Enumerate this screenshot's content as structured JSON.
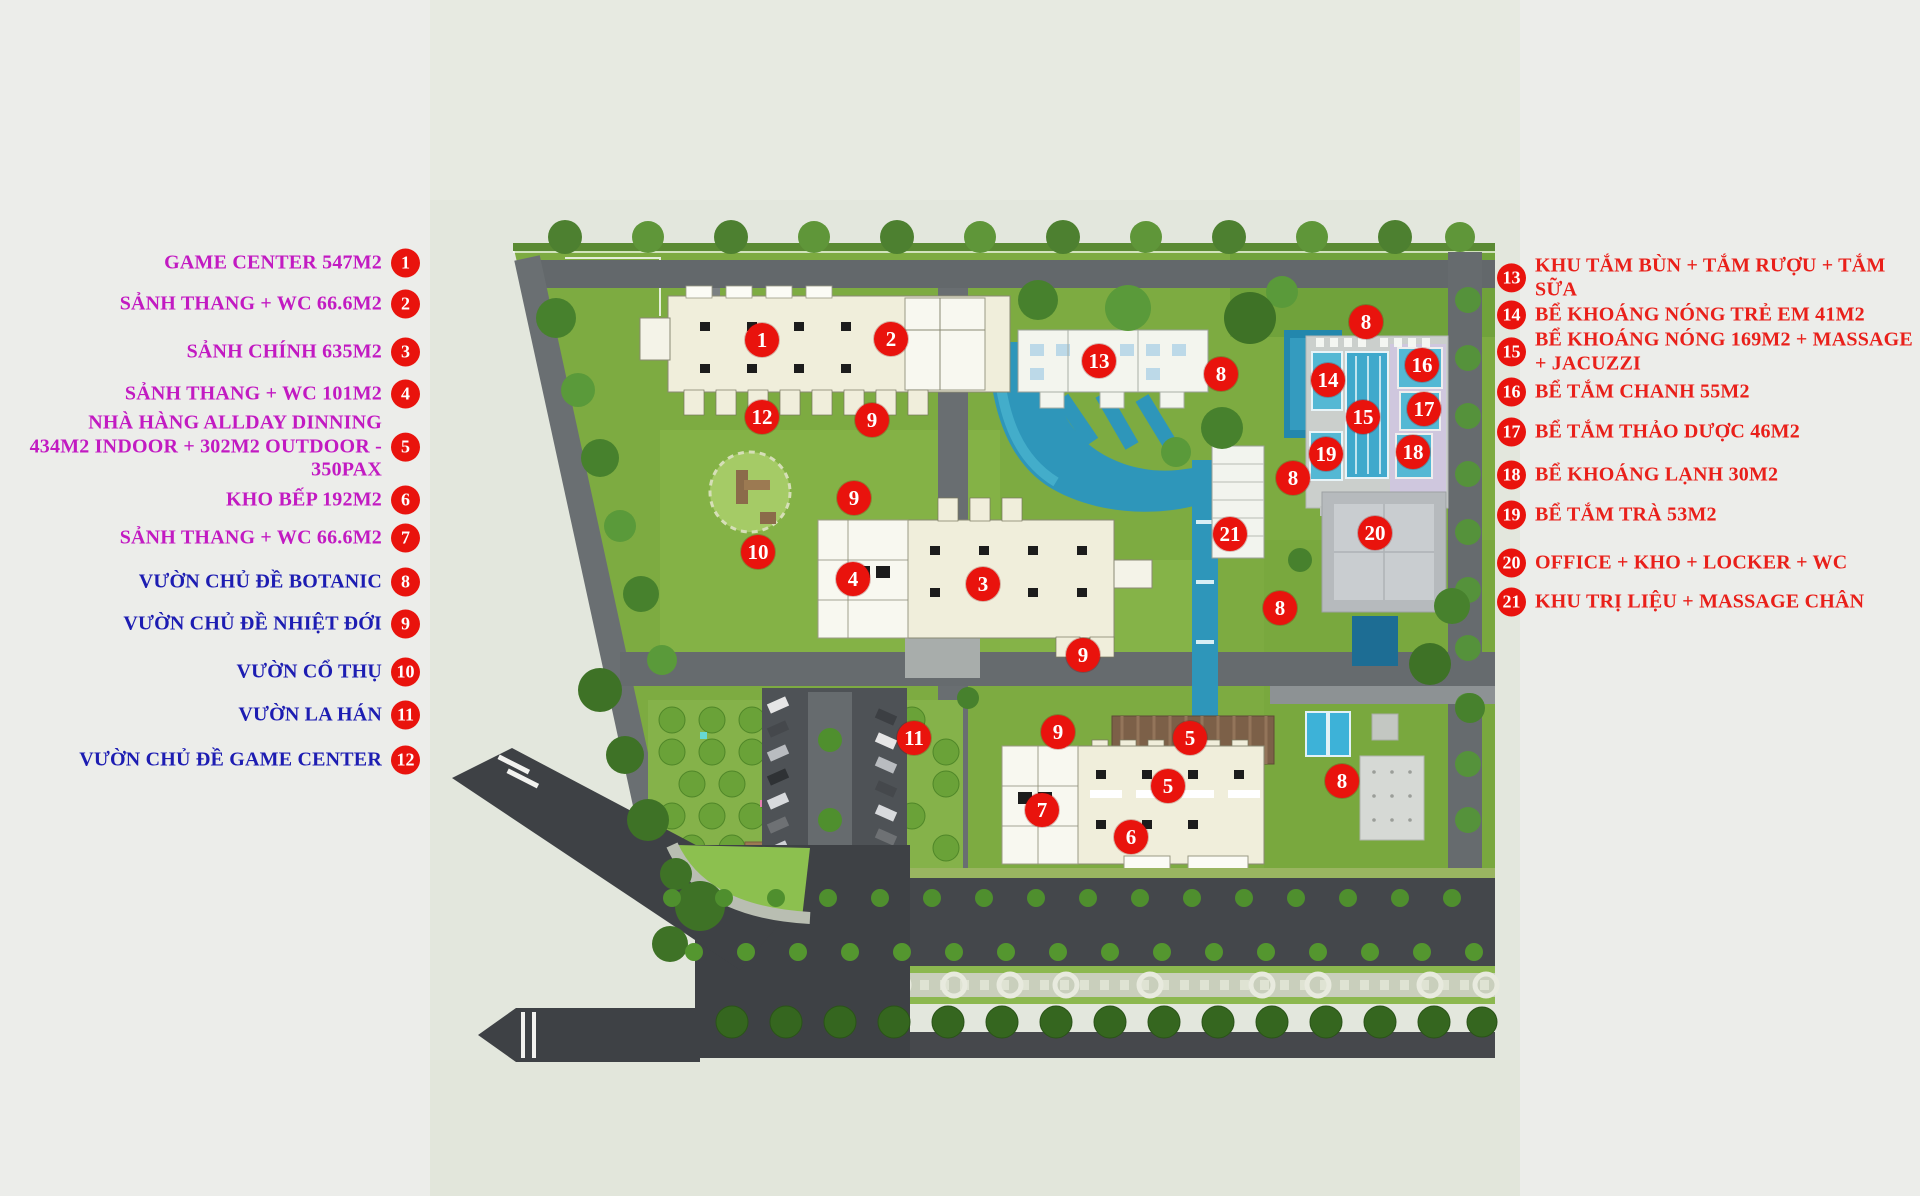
{
  "palette": {
    "legend_magenta": "#c21ac2",
    "legend_blue": "#1d1db2",
    "legend_red": "#e9201a",
    "badge_red": "#e9130d",
    "site_green": "#7dab41",
    "water_blue": "#3fa9cc",
    "building_cream": "#f0eedb",
    "road_gray": "#63686b",
    "asphalt_dark": "#3f4246"
  },
  "legend_left": [
    {
      "num": "1",
      "text": "GAME CENTER 547M2",
      "y": 263,
      "group": "facility"
    },
    {
      "num": "2",
      "text": "SẢNH THANG + WC 66.6M2",
      "y": 304,
      "group": "facility"
    },
    {
      "num": "3",
      "text": "SẢNH CHÍNH 635M2",
      "y": 352,
      "group": "facility"
    },
    {
      "num": "4",
      "text": "SẢNH THANG + WC 101M2",
      "y": 394,
      "group": "facility"
    },
    {
      "num": "5",
      "text": "NHÀ HÀNG ALLDAY DINNING\n434M2 INDOOR + 302M2 OUTDOOR - 350PAX",
      "y": 447,
      "group": "facility"
    },
    {
      "num": "6",
      "text": "KHO BẾP 192M2",
      "y": 500,
      "group": "facility"
    },
    {
      "num": "7",
      "text": "SẢNH THANG + WC 66.6M2",
      "y": 538,
      "group": "facility"
    },
    {
      "num": "8",
      "text": "VƯỜN CHỦ ĐỀ BOTANIC",
      "y": 582,
      "group": "garden"
    },
    {
      "num": "9",
      "text": "VƯỜN CHỦ ĐỀ NHIỆT ĐỚI",
      "y": 624,
      "group": "garden"
    },
    {
      "num": "10",
      "text": "VƯỜN CỔ THỤ",
      "y": 672,
      "group": "garden"
    },
    {
      "num": "11",
      "text": "VƯỜN LA HÁN",
      "y": 715,
      "group": "garden"
    },
    {
      "num": "12",
      "text": "VƯỜN CHỦ ĐỀ GAME CENTER",
      "y": 760,
      "group": "garden"
    }
  ],
  "legend_right": [
    {
      "num": "13",
      "text": "KHU TẮM BÙN + TẮM RƯỢU + TẮM SỮA",
      "y": 278
    },
    {
      "num": "14",
      "text": "BỂ KHOÁNG NÓNG TRẺ EM 41M2",
      "y": 315
    },
    {
      "num": "15",
      "text": "BỂ KHOÁNG NÓNG 169M2 + MASSAGE + JACUZZI",
      "y": 352
    },
    {
      "num": "16",
      "text": "BỂ TẮM CHANH 55M2",
      "y": 392
    },
    {
      "num": "17",
      "text": "BỂ TẮM THẢO DƯỢC 46M2",
      "y": 432
    },
    {
      "num": "18",
      "text": "BỂ KHOÁNG LẠNH 30M2",
      "y": 475
    },
    {
      "num": "19",
      "text": "BỂ TẮM TRÀ 53M2",
      "y": 515
    },
    {
      "num": "20",
      "text": "OFFICE + KHO + LOCKER + WC",
      "y": 563
    },
    {
      "num": "21",
      "text": "KHU TRỊ LIỆU + MASSAGE CHÂN",
      "y": 602
    }
  ],
  "map": {
    "markers": [
      {
        "n": "1",
        "x": 762,
        "y": 340
      },
      {
        "n": "2",
        "x": 891,
        "y": 339
      },
      {
        "n": "12",
        "x": 762,
        "y": 417
      },
      {
        "n": "9",
        "x": 872,
        "y": 420
      },
      {
        "n": "9",
        "x": 854,
        "y": 498
      },
      {
        "n": "10",
        "x": 758,
        "y": 552
      },
      {
        "n": "13",
        "x": 1099,
        "y": 361
      },
      {
        "n": "8",
        "x": 1221,
        "y": 374
      },
      {
        "n": "8",
        "x": 1366,
        "y": 322
      },
      {
        "n": "14",
        "x": 1328,
        "y": 380
      },
      {
        "n": "15",
        "x": 1363,
        "y": 417
      },
      {
        "n": "16",
        "x": 1422,
        "y": 365
      },
      {
        "n": "17",
        "x": 1424,
        "y": 409
      },
      {
        "n": "18",
        "x": 1413,
        "y": 452
      },
      {
        "n": "19",
        "x": 1326,
        "y": 454
      },
      {
        "n": "8",
        "x": 1293,
        "y": 478
      },
      {
        "n": "20",
        "x": 1375,
        "y": 533
      },
      {
        "n": "21",
        "x": 1230,
        "y": 534
      },
      {
        "n": "8",
        "x": 1280,
        "y": 608
      },
      {
        "n": "4",
        "x": 853,
        "y": 579
      },
      {
        "n": "3",
        "x": 983,
        "y": 584
      },
      {
        "n": "9",
        "x": 1083,
        "y": 655
      },
      {
        "n": "9",
        "x": 1058,
        "y": 732
      },
      {
        "n": "11",
        "x": 914,
        "y": 738
      },
      {
        "n": "5",
        "x": 1190,
        "y": 738
      },
      {
        "n": "5",
        "x": 1168,
        "y": 786
      },
      {
        "n": "7",
        "x": 1042,
        "y": 810
      },
      {
        "n": "6",
        "x": 1131,
        "y": 837
      },
      {
        "n": "8",
        "x": 1342,
        "y": 781
      }
    ]
  }
}
